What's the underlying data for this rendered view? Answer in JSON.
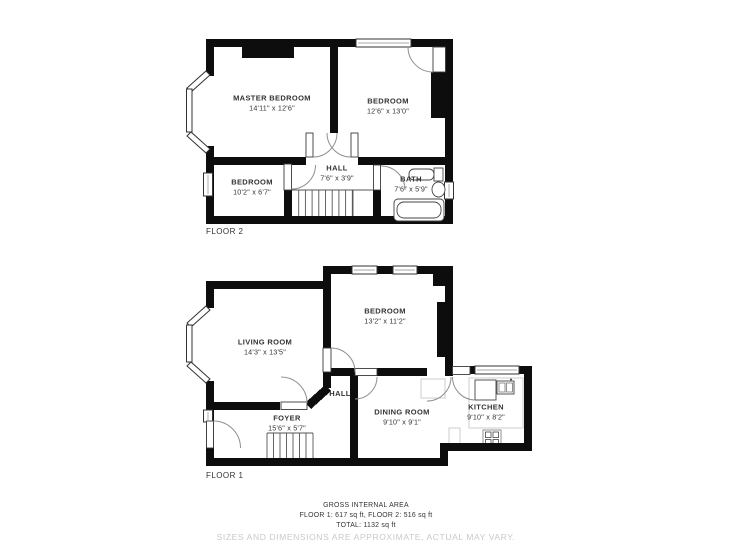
{
  "floor2": {
    "label": "FLOOR 2",
    "rooms": [
      {
        "name": "MASTER BEDROOM",
        "dims": "14'11\" x 12'6\""
      },
      {
        "name": "BEDROOM",
        "dims": "12'6\" x 13'0\""
      },
      {
        "name": "BEDROOM",
        "dims": "10'2\" x 6'7\""
      },
      {
        "name": "HALL",
        "dims": "7'6\" x 3'9\""
      },
      {
        "name": "BATH",
        "dims": "7'6\" x 5'9\""
      }
    ]
  },
  "floor1": {
    "label": "FLOOR 1",
    "rooms": [
      {
        "name": "LIVING ROOM",
        "dims": "14'3\" x 13'5\""
      },
      {
        "name": "BEDROOM",
        "dims": "13'2\" x 11'2\""
      },
      {
        "name": "HALL",
        "dims": ""
      },
      {
        "name": "FOYER",
        "dims": "15'6\" x 5'7\""
      },
      {
        "name": "DINING ROOM",
        "dims": "9'10\" x 9'1\""
      },
      {
        "name": "KITCHEN",
        "dims": "9'10\" x 8'2\""
      }
    ]
  },
  "footer": {
    "title": "GROSS INTERNAL AREA",
    "areas_line": "FLOOR 1: 617 sq ft, FLOOR 2: 516 sq ft",
    "total_line": "TOTAL: 1132 sq ft",
    "disclaimer": "SIZES AND DIMENSIONS ARE APPROXIMATE, ACTUAL MAY VARY."
  },
  "colors": {
    "wall": "#0d0d0d",
    "text": "#333333",
    "disclaimer_text": "#c9c9c9"
  }
}
